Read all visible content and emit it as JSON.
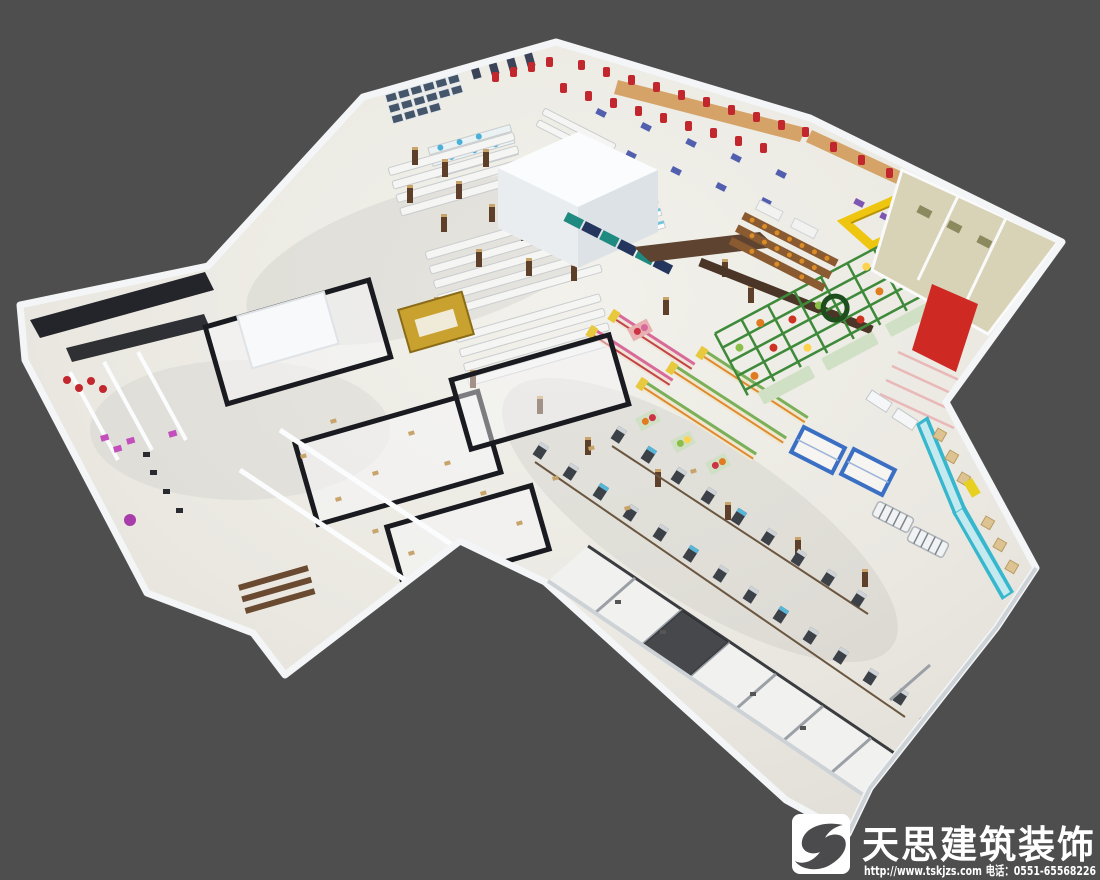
{
  "meta": {
    "description": "3D isometric rendering of a supermarket / shopping mall interior floor plan on dark gray background",
    "canvas": {
      "width": 1100,
      "height": 880
    }
  },
  "palette": {
    "background": "#4e4e4e",
    "wall_white": "#f3f5f7",
    "wall_shade": "#cdd2d7",
    "floor_light": "#f0efe9",
    "floor_dark": "#e0ded6",
    "apparel_tan": "#d5a368",
    "garment_red": "#c1272d",
    "produce_green": "#3e8a3a",
    "crate_orange": "#e07b20",
    "canopy_yellow": "#eec50f",
    "freezer_cyan": "#36b7cd",
    "rack_blue": "#3a6fc4",
    "service_beige": "#d8d2b6",
    "escalator_red": "#ce2a23",
    "frame_dark": "#1a1b20",
    "checkout_dark": "#3c4148",
    "boutique_magenta": "#c34fbc",
    "tile_tan": "#c8a36a",
    "teal_sign": "#1f8a80",
    "wood_brown": "#5d4330",
    "pillar_brown": "#5d3f2a",
    "screen_navy": "#45566b",
    "watermark_white": "#ffffff",
    "logo_glyph_gray": "#4b4b4e"
  },
  "regions": [
    {
      "name": "building-outline",
      "label": "supermarket building shell"
    },
    {
      "name": "apparel-zone",
      "label": "apparel racks with red garments along top wall"
    },
    {
      "name": "tv-wall",
      "label": "electronics screen wall, top-left"
    },
    {
      "name": "central-atrium-cube",
      "label": "large white block / core"
    },
    {
      "name": "gondola-shelving",
      "label": "white gondola shelving rows"
    },
    {
      "name": "produce-zone",
      "label": "green produce racks with fruit crates"
    },
    {
      "name": "bakery-shelves",
      "label": "wooden bread shelving"
    },
    {
      "name": "yellow-canopy",
      "label": "yellow canopy frame structure"
    },
    {
      "name": "service-rooms",
      "label": "beige back-of-house rooms, right wing"
    },
    {
      "name": "escalator",
      "label": "red escalator ramp"
    },
    {
      "name": "freezer-aisle",
      "label": "cyan refrigerated cases, lower-right wing"
    },
    {
      "name": "checkout-lanes",
      "label": "diagonal rows of checkout counters"
    },
    {
      "name": "tenant-shops-strip",
      "label": "strip of small tenant shops along bottom edge"
    },
    {
      "name": "mall-boutique-frames",
      "label": "dark glass-framed boutique rooms, center-left"
    },
    {
      "name": "left-boutique-wing",
      "label": "boutique shops wing, far left"
    },
    {
      "name": "watermark",
      "label": "company watermark with logo"
    }
  ],
  "watermark": {
    "logo_glyph": "S",
    "brand": "天思建筑装饰",
    "url": "http://www.tskjzs.com",
    "phone_label": "电话：",
    "phone_number": "0551-65568226"
  }
}
